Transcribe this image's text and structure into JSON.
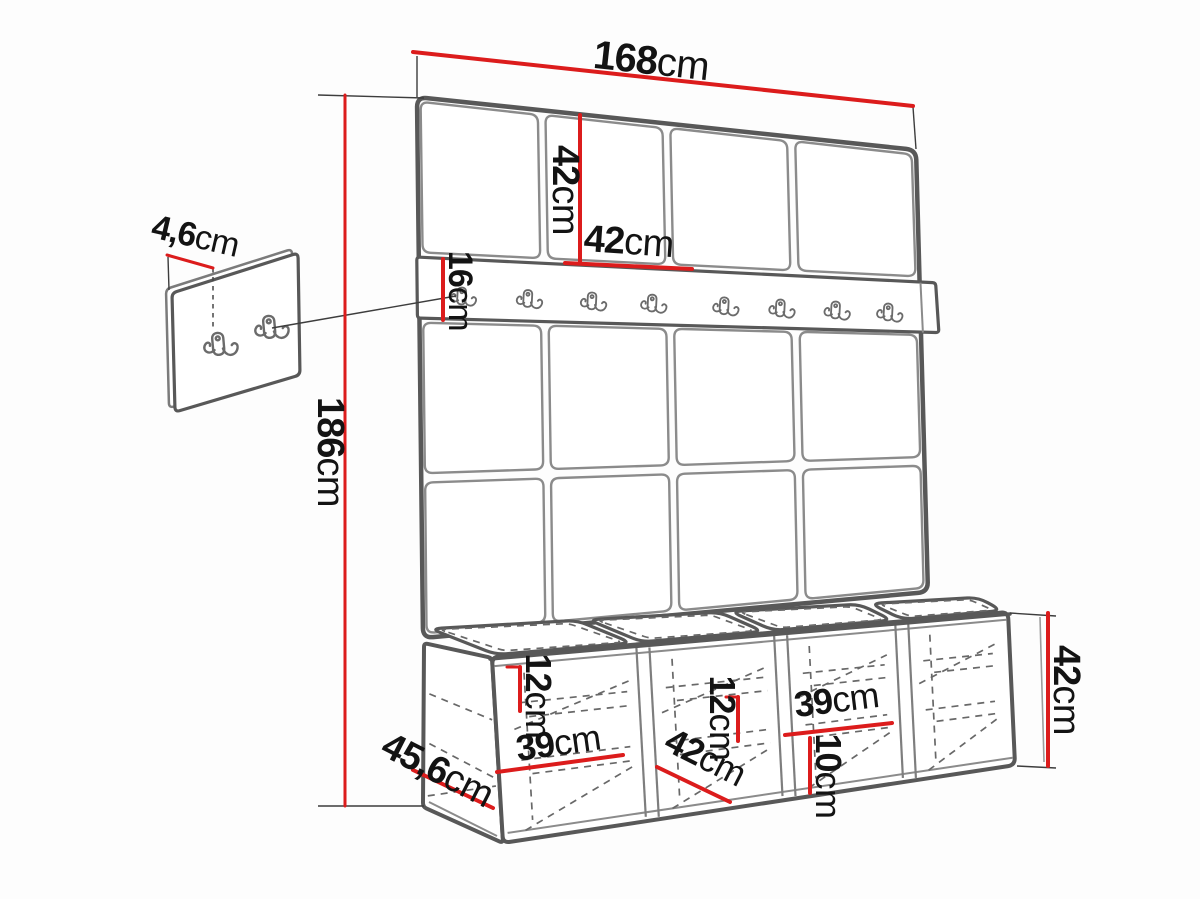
{
  "diagram": {
    "subject": "hallway wall-panel set with coat hook rail and storage bench",
    "dimensions": {
      "total_width": {
        "value": "168",
        "unit": "cm"
      },
      "panel_tile_height": {
        "value": "42",
        "unit": "cm"
      },
      "panel_tile_width": {
        "value": "42",
        "unit": "cm"
      },
      "hook_rail_height": {
        "value": "16",
        "unit": "cm"
      },
      "total_height": {
        "value": "186",
        "unit": "cm"
      },
      "wall_panel_thickness": {
        "value": "4,6",
        "unit": "cm"
      },
      "bench_depth": {
        "value": "45,6",
        "unit": "cm"
      },
      "bench_inner_height_1": {
        "value": "12",
        "unit": "cm"
      },
      "bench_compartment_width_1": {
        "value": "39",
        "unit": "cm"
      },
      "bench_compartment_width_2": {
        "value": "42",
        "unit": "cm"
      },
      "bench_inner_height_2": {
        "value": "12",
        "unit": "cm"
      },
      "bench_compartment_width_3": {
        "value": "39",
        "unit": "cm"
      },
      "bench_shelf_height": {
        "value": "10",
        "unit": "cm"
      },
      "bench_height": {
        "value": "42",
        "unit": "cm"
      }
    },
    "structure": {
      "panel_columns": 4,
      "panel_rows": 3,
      "rail_hooks": 8,
      "detail_hooks": 2,
      "bench_compartments": 4,
      "bench_cushions": 4
    },
    "colors": {
      "dimension_line": "#dc1c1c",
      "outline": "#585858",
      "seam": "#8b8b8b",
      "hidden_line": "#686868",
      "label_text": "#131313",
      "background": "#fdfdfd"
    }
  }
}
